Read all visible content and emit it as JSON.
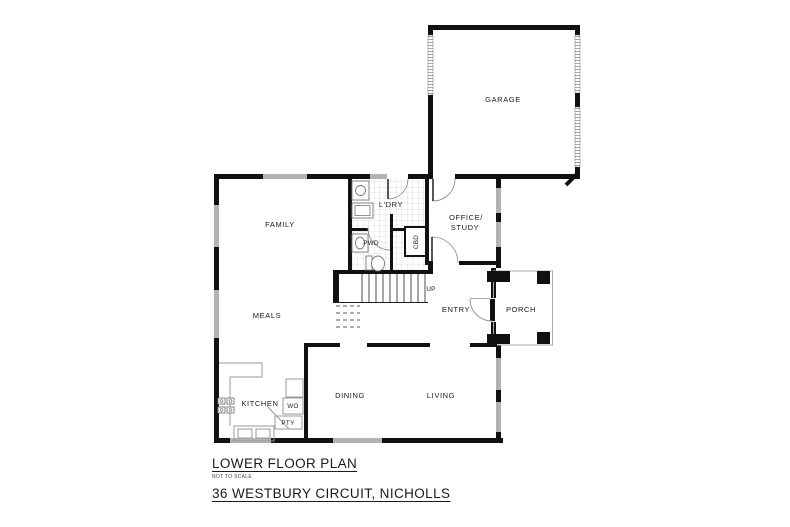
{
  "footer": {
    "plan_title": "LOWER FLOOR PLAN",
    "scale_note": "NOT TO SCALE",
    "address": "36 WESTBURY CIRCUIT, NICHOLLS"
  },
  "rooms": {
    "garage": "GARAGE",
    "family": "FAMILY",
    "meals": "MEALS",
    "laundry": "L'DRY",
    "powder": "PWD",
    "cupboard": "CBD",
    "office_line1": "OFFICE/",
    "office_line2": "STUDY",
    "entry": "ENTRY",
    "porch": "PORCH",
    "kitchen": "KITCHEN",
    "dining": "DINING",
    "living": "LIVING"
  },
  "annotations": {
    "stairs_up": "UP",
    "wall_oven": "WO",
    "pantry": "PTY"
  },
  "colors": {
    "wall": "#111111",
    "window": "#b3b3b3",
    "tile_line": "#cccccc",
    "bench_line": "#999999",
    "text": "#1a1a1a",
    "background": "#ffffff"
  }
}
